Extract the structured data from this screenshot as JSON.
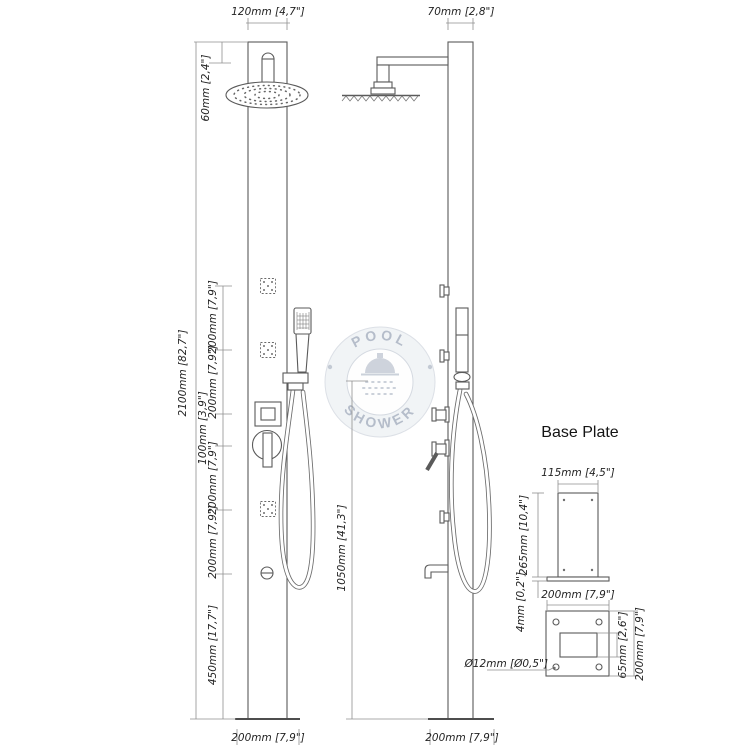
{
  "watermark": {
    "top": "POOL",
    "bottom": "SHOWER"
  },
  "front_view": {
    "width": "120mm [4,7\"]",
    "head_drop": "60mm [2,4\"]",
    "total_height": "2100mm [82,7\"]",
    "segments": [
      "200mm [7,9\"]",
      "200mm [7,9\"]",
      "100mm [3,9\"]",
      "200mm [7,9\"]",
      "200mm [7,9\"]",
      "450mm [17,7\"]"
    ],
    "base_width": "200mm [7,9\"]"
  },
  "side_view": {
    "depth": "70mm [2,8\"]",
    "hand_shower_height": "1050mm [41,3\"]",
    "base_depth": "200mm [7,9\"]"
  },
  "base_plate": {
    "title": "Base Plate",
    "column_width": "115mm [4,5\"]",
    "column_height": "265mm [10,4\"]",
    "plate_thickness": "4mm [0,2\"]",
    "plate_width": "200mm [7,9\"]",
    "hole_diameter": "Ø12mm [Ø0,5\"]",
    "cutout_height": "65mm [2,6\"]",
    "plate_depth": "200mm [7,9\"]"
  },
  "colors": {
    "line": "#5a5a5a",
    "dim_line": "#8f8f8f",
    "text": "#232323",
    "watermark": "#aab3c1"
  }
}
